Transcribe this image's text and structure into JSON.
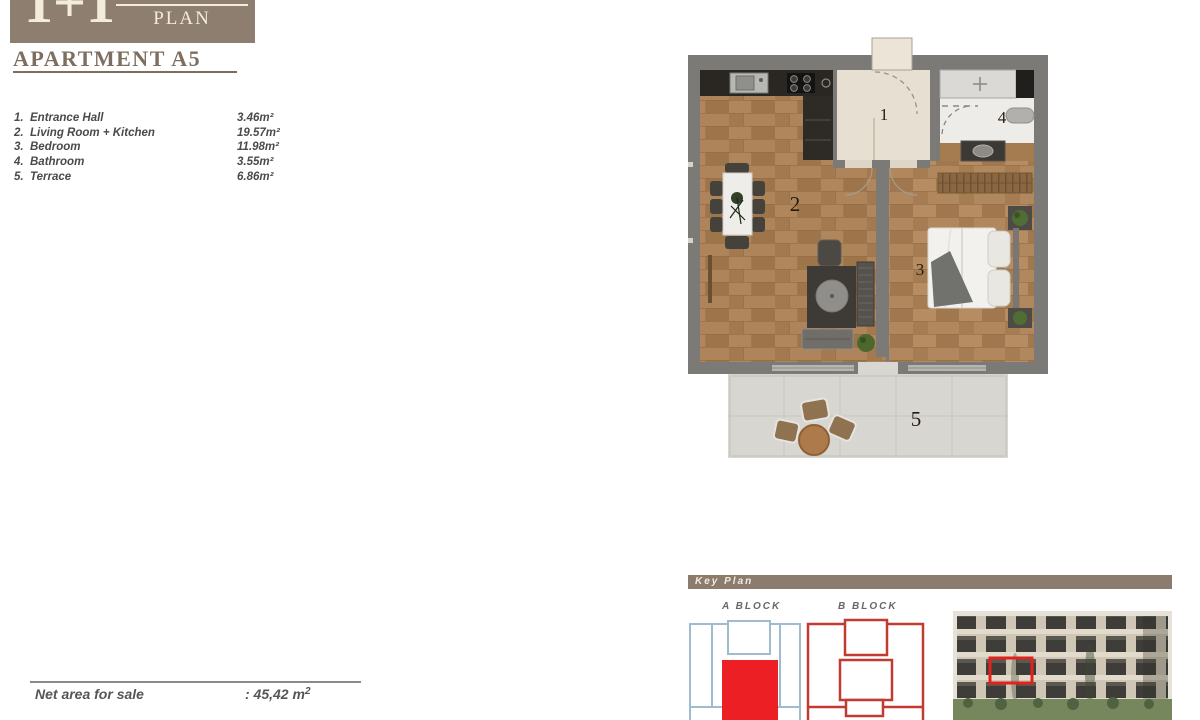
{
  "logo": {
    "number": "1+1",
    "top_word": "APARTMENT",
    "bottom_word": "PLAN"
  },
  "title": {
    "text": "APARTMENT A5"
  },
  "room_list": {
    "items": [
      {
        "number": "1.",
        "name": "Entrance Hall",
        "area": "3.46m²"
      },
      {
        "number": "2.",
        "name": "Living Room + Kitchen",
        "area": "19.57m²"
      },
      {
        "number": "3.",
        "name": "Bedroom",
        "area": "11.98m²"
      },
      {
        "number": "4.",
        "name": "Bathroom",
        "area": "3.55m²"
      },
      {
        "number": "5.",
        "name": "Terrace",
        "area": "6.86m²"
      }
    ]
  },
  "plan": {
    "room_labels": [
      "1",
      "2",
      "3",
      "4",
      "5"
    ]
  },
  "key_plan": {
    "title": "Key Plan",
    "block_a_label": "A BLOCK",
    "block_b_label": "B BLOCK"
  },
  "net_area": {
    "label": "Net area for sale",
    "value": ": 45,42  m",
    "superscript": "2"
  },
  "colors": {
    "brand_brown": "#8d7e6f",
    "title_brown": "#7d6e5f",
    "wall_gray": "#7b7a76",
    "wood_floor": "#a87f55",
    "terrace_gray": "#d8d6d0",
    "highlight_red": "#ec1f24",
    "block_a_outline": "#9fbcce",
    "block_b_outline": "#c23b33"
  }
}
